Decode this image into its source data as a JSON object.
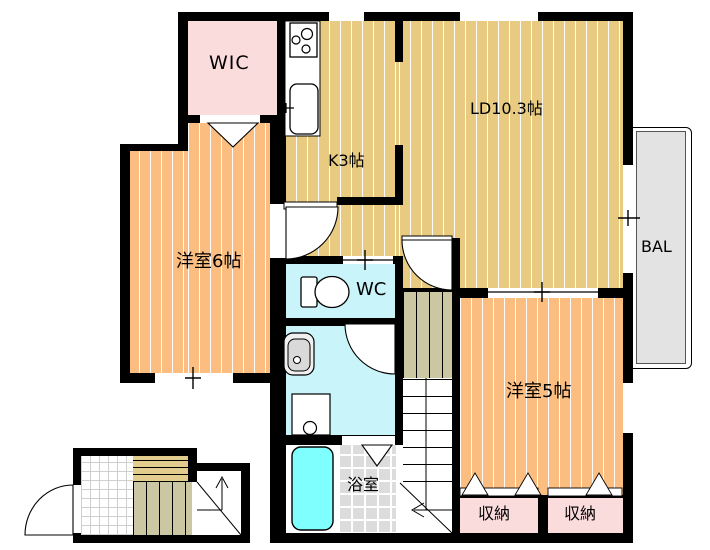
{
  "floorplan": {
    "rooms": {
      "walk_in_closet": {
        "label": "WIC"
      },
      "kitchen": {
        "label": "K3帖"
      },
      "living_dining": {
        "label": "LD10.3帖"
      },
      "bedroom_6": {
        "label": "洋室6帖"
      },
      "toilet": {
        "label": "WC"
      },
      "washroom": {
        "label": ""
      },
      "bathroom": {
        "label": "浴室"
      },
      "bedroom_5": {
        "label": "洋室5帖"
      },
      "storage_left": {
        "label": "収納"
      },
      "storage_right": {
        "label": "収納"
      },
      "balcony": {
        "label": "BAL"
      }
    },
    "colors": {
      "wall": "#000000",
      "tatami_tan": "#e8cb81",
      "room_orange": "#fbbd80",
      "closet_pink": "#fbdcdc",
      "water_blue": "#c9f4fa",
      "bathtub_cyan": "#80ffff",
      "tile_gray": "#dcdcdc",
      "balcony_gray": "#e3e3e3",
      "stairs_khaki": "#ccc7a3",
      "steps_tan": "#e3cd8e"
    },
    "fixtures": [
      "stove-icon",
      "kitchen-sink-icon",
      "toilet-icon",
      "washbasin-icon",
      "washing-machine-icon",
      "bathtub-icon",
      "stairs-up-arrow-icon",
      "stairs-direction-arrow-icon"
    ]
  }
}
